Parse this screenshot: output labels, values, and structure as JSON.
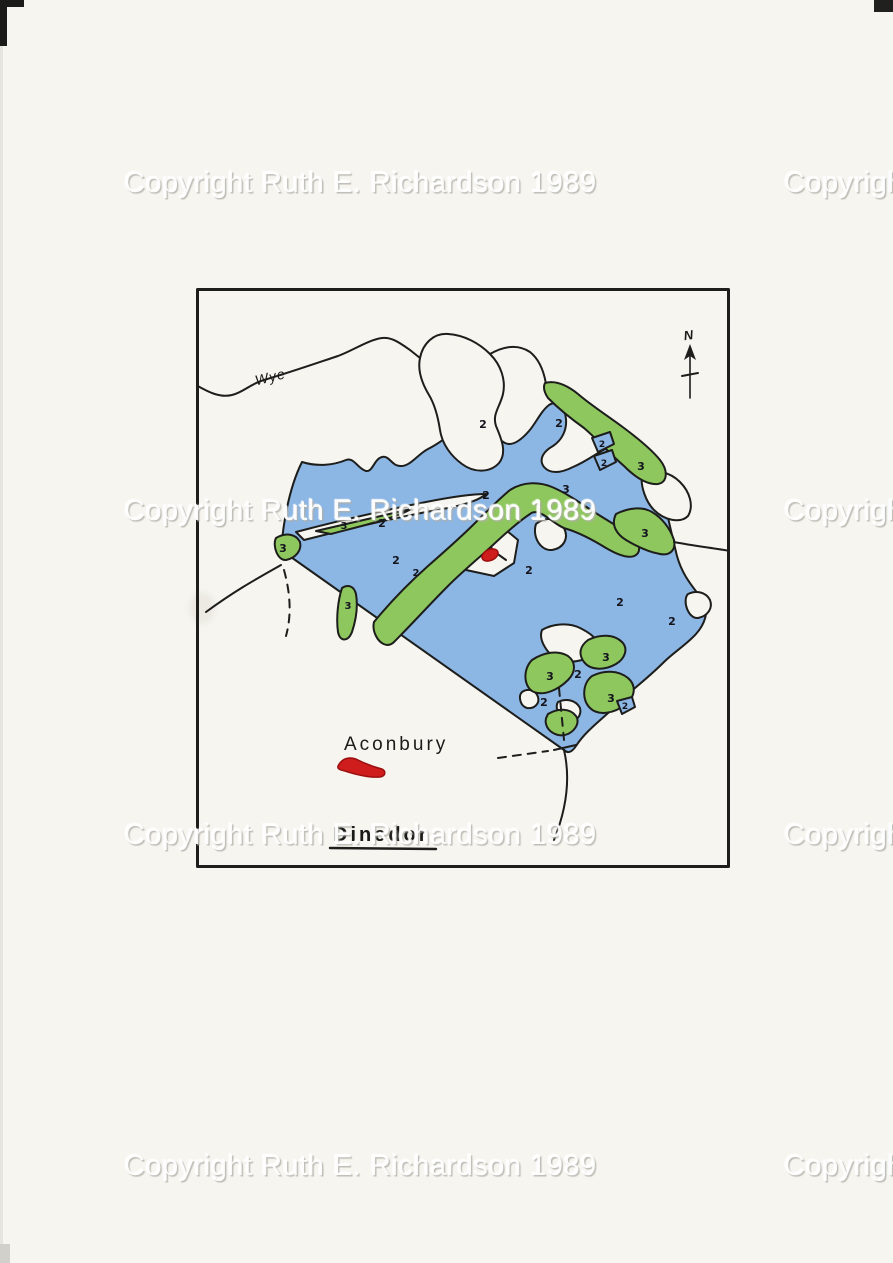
{
  "page": {
    "watermark_text": "Copyright Ruth E. Richardson 1989"
  },
  "map": {
    "title_label": "Dinedor",
    "site_label": "Aconbury",
    "river_label": "Wye",
    "north_label": "N",
    "region_numbers": [
      {
        "v": "2",
        "x": 287,
        "y": 140,
        "s": 11,
        "t": "water"
      },
      {
        "v": "2",
        "x": 363,
        "y": 139,
        "s": 11,
        "t": "water"
      },
      {
        "v": "2",
        "x": 406,
        "y": 159,
        "s": 9,
        "t": "water"
      },
      {
        "v": "2",
        "x": 408,
        "y": 178,
        "s": 9,
        "t": "water"
      },
      {
        "v": "2",
        "x": 290,
        "y": 211,
        "s": 11,
        "t": "water"
      },
      {
        "v": "2",
        "x": 186,
        "y": 239,
        "s": 11,
        "t": "water"
      },
      {
        "v": "2",
        "x": 200,
        "y": 276,
        "s": 11,
        "t": "water"
      },
      {
        "v": "2",
        "x": 220,
        "y": 288,
        "s": 10,
        "t": "water"
      },
      {
        "v": "2",
        "x": 333,
        "y": 286,
        "s": 11,
        "t": "water"
      },
      {
        "v": "2",
        "x": 424,
        "y": 318,
        "s": 11,
        "t": "water"
      },
      {
        "v": "2",
        "x": 476,
        "y": 337,
        "s": 11,
        "t": "water"
      },
      {
        "v": "2",
        "x": 382,
        "y": 390,
        "s": 11,
        "t": "water"
      },
      {
        "v": "2",
        "x": 348,
        "y": 418,
        "s": 11,
        "t": "water"
      },
      {
        "v": "2",
        "x": 429,
        "y": 421,
        "s": 9,
        "t": "water"
      },
      {
        "v": "3",
        "x": 87,
        "y": 264,
        "s": 11,
        "t": "wood"
      },
      {
        "v": "3",
        "x": 148,
        "y": 241,
        "s": 10,
        "t": "wood"
      },
      {
        "v": "3",
        "x": 445,
        "y": 182,
        "s": 11,
        "t": "wood"
      },
      {
        "v": "3",
        "x": 370,
        "y": 205,
        "s": 11,
        "t": "wood"
      },
      {
        "v": "3",
        "x": 449,
        "y": 249,
        "s": 11,
        "t": "wood"
      },
      {
        "v": "3",
        "x": 152,
        "y": 321,
        "s": 10,
        "t": "wood"
      },
      {
        "v": "3",
        "x": 354,
        "y": 392,
        "s": 11,
        "t": "wood"
      },
      {
        "v": "3",
        "x": 410,
        "y": 373,
        "s": 11,
        "t": "wood"
      },
      {
        "v": "3",
        "x": 415,
        "y": 414,
        "s": 11,
        "t": "wood"
      }
    ]
  },
  "colors": {
    "paper": "#f6f5f0",
    "ink": "#1d1d1b",
    "water": "#8cb6e4",
    "wood": "#8fc75f",
    "red": "#cf1d1d"
  }
}
